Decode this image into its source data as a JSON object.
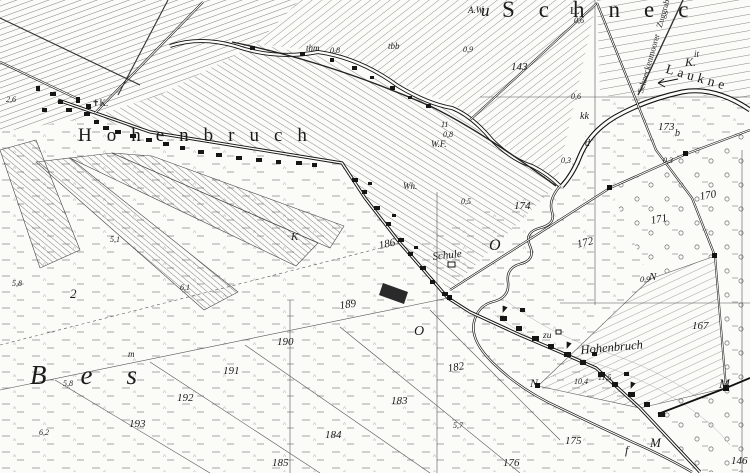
{
  "map": {
    "colors": {
      "ink": "#1b1b1b",
      "paper": "#fbfbf8",
      "hatch": "#606060",
      "marsh": "#9a9a9a",
      "road": "#111111"
    },
    "place_names": {
      "hohenbruch_large": "Hohenbruch",
      "schnec_partial": "Schnec",
      "schnec_prefix_partial": "u",
      "bes_partial": "Bes",
      "hohenbruch_village": "Hohenbruch"
    },
    "water": {
      "river_name": "Laukne",
      "river_abbrev": "K.",
      "ditch_name_line1": "Schneckenmoorer",
      "ditch_name_line2": "Zuggraben"
    },
    "features": {
      "school": "Schule",
      "church_abbrev": "✝K.",
      "wh": "Wh.",
      "wf": "W.F.",
      "zu": "zu",
      "thm": "thm",
      "tbb": "tbb",
      "aw": "A.W."
    },
    "letter_marks": {
      "l_dot": "L.",
      "it": "it",
      "kk": "kk",
      "d": "d",
      "b": "b",
      "o_upper": "O",
      "o_lower": "O",
      "two": "2",
      "m_small": "m",
      "k_italic": "K",
      "n_road": "N",
      "n_cross": "N",
      "m_junction": "M",
      "m_road": "M",
      "f": "f"
    },
    "parcel_numbers": {
      "p143": "143",
      "p146": "146",
      "p167": "167",
      "p170": "170",
      "p171": "171",
      "p172": "172",
      "p173": "173",
      "p174": "174",
      "p175": "175",
      "p176": "176",
      "p182": "182",
      "p183": "183",
      "p184": "184",
      "p185": "185",
      "p186": "186",
      "p189": "189",
      "p190": "190",
      "p191": "191",
      "p192": "192",
      "p193": "193"
    },
    "spot_values": {
      "v115": "11,5",
      "v104": "10,4",
      "v11": "11",
      "v08a": "0,8",
      "v08b": "0,8",
      "v09a": "0,9",
      "v09b": "0,9",
      "v03a": "0,3",
      "v03b": "0,3",
      "v05": "0,5",
      "v06a": "0,6",
      "v06b": "0,6",
      "v51": "5,1",
      "v57": "5,7",
      "v58a": "5,8",
      "v58b": "5,8",
      "v61": "6,1",
      "v62": "6,2",
      "v26": "2,6"
    }
  }
}
